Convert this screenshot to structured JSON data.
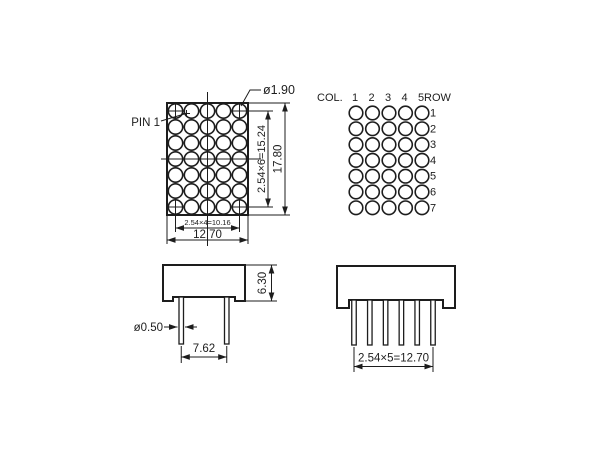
{
  "front_view": {
    "pin1_label": "PIN 1",
    "dot_diameter_label": "ø1.90",
    "height_pitch_label": "2.54×6=15.24",
    "height_overall_label": "17.80",
    "width_pitch_label": "2.54×4=10.16",
    "width_overall_label": "12.70"
  },
  "pinout_view": {
    "col_header": "COL.",
    "row_header": "ROW",
    "col_labels": [
      "1",
      "2",
      "3",
      "4",
      "5"
    ],
    "row_labels": [
      "1",
      "2",
      "3",
      "4",
      "5",
      "6",
      "7"
    ]
  },
  "side_view": {
    "body_height_label": "6.30",
    "pin_diameter_label": "ø0.50",
    "pin_spacing_label": "7.62"
  },
  "bottom_view": {
    "pin_row_width_label": "2.54×5=12.70"
  },
  "colors": {
    "line": "#1d1d1d",
    "background": "#ffffff"
  }
}
